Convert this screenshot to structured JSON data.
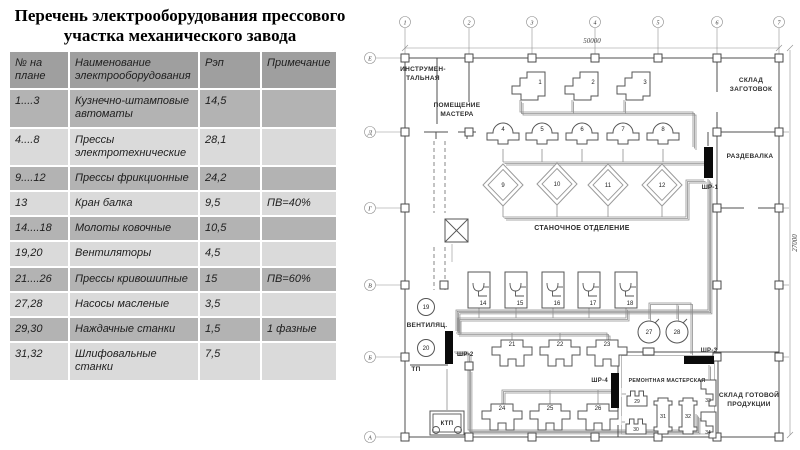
{
  "title": "Перечень электрооборудования прессового участка механического завода",
  "table": {
    "headers": [
      "№ на плане",
      "Наименование электрооборудования",
      "Рэп",
      "Примечание"
    ],
    "rows": [
      [
        "1....3",
        "Кузнечно-штамповые автоматы",
        "14,5",
        ""
      ],
      [
        "4....8",
        "Прессы электротехнические",
        "28,1",
        ""
      ],
      [
        "9....12",
        "Прессы фрикционные",
        "24,2",
        ""
      ],
      [
        "13",
        "Кран балка",
        "9,5",
        "ПВ=40%"
      ],
      [
        "14....18",
        "Молоты ковочные",
        "10,5",
        ""
      ],
      [
        "19,20",
        "Вентиляторы",
        "4,5",
        ""
      ],
      [
        "21....26",
        "Прессы кривошипные",
        "15",
        "ПВ=60%"
      ],
      [
        "27,28",
        "Насосы масленые",
        "3,5",
        ""
      ],
      [
        "29,30",
        "Наждачные станки",
        "1,5",
        "1 фазные"
      ],
      [
        "31,32",
        "Шлифовальные станки",
        "7,5",
        ""
      ]
    ]
  },
  "plan": {
    "grid": {
      "top_labels": [
        "1",
        "2",
        "3",
        "4",
        "5",
        "6",
        "7"
      ],
      "left_labels": [
        "Е",
        "Д",
        "Г",
        "В",
        "Б",
        "А"
      ],
      "width_dim": "50000",
      "height_dim": "27000"
    },
    "rooms": [
      {
        "name": "tool-room",
        "lines": [
          "ИНСТРУМЕН-",
          "ТАЛЬНАЯ"
        ],
        "x": 63,
        "y": 71,
        "size": 6.5
      },
      {
        "name": "master-room",
        "lines": [
          "ПОМЕЩЕНИЕ",
          "МАСТЕРА"
        ],
        "x": 97,
        "y": 107,
        "size": 6.5
      },
      {
        "name": "blank-warehouse",
        "lines": [
          "СКЛАД",
          "ЗАГОТОВОК"
        ],
        "x": 391,
        "y": 82,
        "size": 6.5
      },
      {
        "name": "locker-room",
        "lines": [
          "РАЗДЕВАЛКА"
        ],
        "x": 390,
        "y": 158,
        "size": 6.5
      },
      {
        "name": "machine-section",
        "lines": [
          "СТАНОЧНОЕ ОТДЕЛЕНИЕ"
        ],
        "x": 222,
        "y": 230,
        "size": 7
      },
      {
        "name": "ventilation",
        "lines": [
          "ВЕНТИЛЯЦ."
        ],
        "x": 67,
        "y": 327,
        "size": 6.5
      },
      {
        "name": "repair-shop",
        "lines": [
          "РЕМОНТНАЯ МАСТЕРСКАЯ"
        ],
        "x": 307,
        "y": 382,
        "size": 5.2
      },
      {
        "name": "finished-warehouse",
        "lines": [
          "СКЛАД ГОТОВОЙ",
          "ПРОДУКЦИИ"
        ],
        "x": 389,
        "y": 397,
        "size": 6.5
      }
    ],
    "boards": [
      {
        "label": "ШР-1",
        "type": "bar",
        "x": 344,
        "y": 147,
        "w": 9,
        "h": 31,
        "lx": 350,
        "ly": 189,
        "anchor": "middle"
      },
      {
        "label": "ШР-2",
        "type": "bar",
        "x": 85,
        "y": 331,
        "w": 8,
        "h": 33,
        "lx": 97,
        "ly": 356,
        "anchor": "start"
      },
      {
        "label": "ШР-3",
        "type": "bar",
        "x": 324,
        "y": 356,
        "w": 30,
        "h": 8,
        "lx": 349,
        "ly": 352,
        "anchor": "middle"
      },
      {
        "label": "ШР-4",
        "type": "bar",
        "x": 251,
        "y": 373,
        "w": 8,
        "h": 35,
        "lx": 248,
        "ly": 382,
        "anchor": "end"
      },
      {
        "label": "КТП",
        "type": "ktp",
        "x": 70,
        "y": 411,
        "w": 34,
        "h": 24
      },
      {
        "label": "ТП",
        "type": "text",
        "lx": 56,
        "ly": 371
      }
    ],
    "machines": [
      {
        "n": "1",
        "type": "auto",
        "x": 152,
        "y": 70
      },
      {
        "n": "2",
        "type": "auto",
        "x": 205,
        "y": 70
      },
      {
        "n": "3",
        "type": "auto",
        "x": 257,
        "y": 70
      },
      {
        "n": "4",
        "type": "bell",
        "x": 143,
        "y": 130
      },
      {
        "n": "5",
        "type": "bell",
        "x": 182,
        "y": 130
      },
      {
        "n": "6",
        "type": "bell",
        "x": 222,
        "y": 130
      },
      {
        "n": "7",
        "type": "bell",
        "x": 263,
        "y": 130
      },
      {
        "n": "8",
        "type": "bell",
        "x": 303,
        "y": 130
      },
      {
        "n": "9",
        "type": "diamond",
        "x": 143,
        "y": 185
      },
      {
        "n": "10",
        "type": "diamond",
        "x": 197,
        "y": 184
      },
      {
        "n": "11",
        "type": "diamond",
        "x": 248,
        "y": 185
      },
      {
        "n": "12",
        "type": "diamond",
        "x": 302,
        "y": 185
      },
      {
        "n": "",
        "type": "crane",
        "x": 85,
        "y": 219
      },
      {
        "n": "14",
        "type": "hammer",
        "x": 108,
        "y": 272
      },
      {
        "n": "15",
        "type": "hammer",
        "x": 145,
        "y": 272
      },
      {
        "n": "16",
        "type": "hammer",
        "x": 182,
        "y": 272
      },
      {
        "n": "17",
        "type": "hammer",
        "x": 218,
        "y": 272
      },
      {
        "n": "18",
        "type": "hammer",
        "x": 255,
        "y": 272
      },
      {
        "n": "19",
        "type": "fan",
        "x": 66,
        "y": 307
      },
      {
        "n": "20",
        "type": "fan",
        "x": 66,
        "y": 348
      },
      {
        "n": "21",
        "type": "press",
        "x": 132,
        "y": 340
      },
      {
        "n": "22",
        "type": "press",
        "x": 180,
        "y": 340
      },
      {
        "n": "23",
        "type": "press",
        "x": 227,
        "y": 340
      },
      {
        "n": "24",
        "type": "press",
        "x": 122,
        "y": 404
      },
      {
        "n": "25",
        "type": "press",
        "x": 170,
        "y": 404
      },
      {
        "n": "26",
        "type": "press",
        "x": 218,
        "y": 404
      },
      {
        "n": "27",
        "type": "pump",
        "x": 289,
        "y": 332
      },
      {
        "n": "28",
        "type": "pump",
        "x": 317,
        "y": 332
      },
      {
        "n": "29",
        "type": "grinder",
        "x": 267,
        "y": 390
      },
      {
        "n": "30",
        "type": "grinder",
        "x": 266,
        "y": 418
      },
      {
        "n": "31",
        "type": "jar",
        "x": 293,
        "y": 398
      },
      {
        "n": "32",
        "type": "jar",
        "x": 318,
        "y": 398
      },
      {
        "n": "33",
        "type": "bracket",
        "x": 341,
        "y": 380
      },
      {
        "n": "34",
        "type": "bracket",
        "x": 341,
        "y": 412
      }
    ]
  }
}
